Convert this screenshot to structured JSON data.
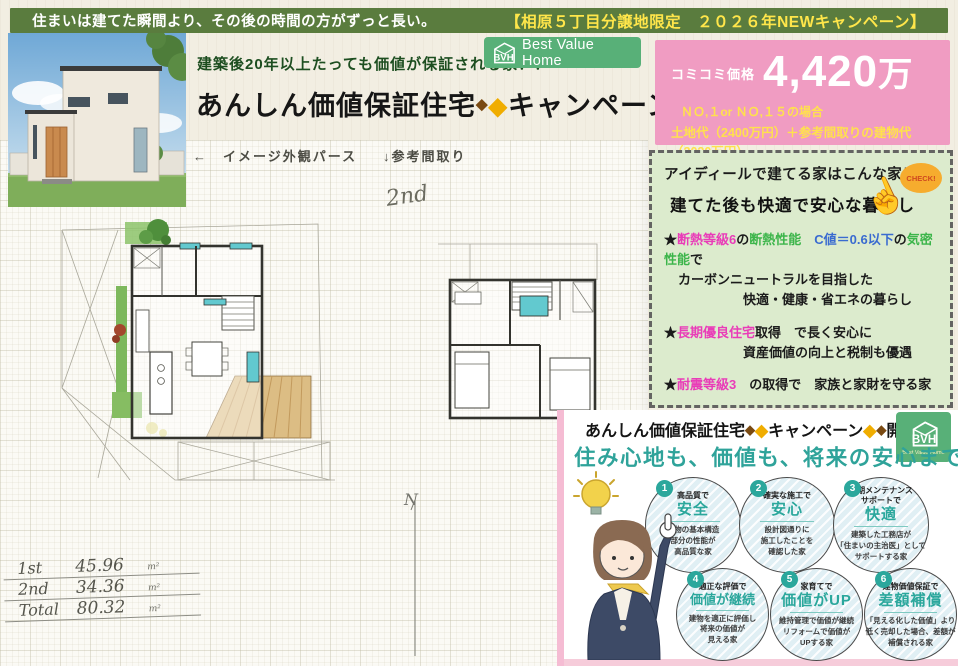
{
  "top_bar": {
    "tagline": "住まいは建てた瞬間より、その後の時間の方がずっと長い。",
    "campaign": "【相原５丁目分譲地限定　２０２６年NEWキャンペーン】"
  },
  "header": {
    "subtitle": "建築後20年以上たっても価値が保証される家！！",
    "title_name": "あんしん価値保証住宅",
    "title_campaign": "キャンペーン",
    "d1": "◆",
    "d2": "◆",
    "d3": "◆",
    "d4": "◆"
  },
  "logo": {
    "monogram": "BVH",
    "name": "Best Value Home"
  },
  "price_box": {
    "label": "コミコミ価格",
    "price_value": "4,420",
    "price_unit": "万",
    "case1": "ＮＯ,１or ＮＯ,１５の場合",
    "case2": "土地代（2400万円）＋参考間取りの建物代（2020万円）",
    "note": "＊付帯工事込、外構工事と諸経費は別途となります"
  },
  "plan_area": {
    "perspective_label": "←　イメージ外観パース",
    "floorplan_label": "↓参考間取り",
    "floor2_note": "2nd",
    "north_label": "N",
    "areas": [
      {
        "name": "1st",
        "value": "45.96",
        "unit": "m²"
      },
      {
        "name": "2nd",
        "value": "34.36",
        "unit": "m²"
      },
      {
        "name": "Total",
        "value": "80.32",
        "unit": "m²"
      }
    ]
  },
  "features": {
    "title1": "アイディールで建てる家はこんな家！",
    "title2": "建てた後も快適で安心な暮らし",
    "check": "CHECK!",
    "hand": "☝",
    "b1": {
      "star": "★",
      "t1": "断熱等級6",
      "t2": "の",
      "t3": "断熱性能",
      "t4": "　C値＝0.6以下",
      "t5": "の",
      "t6": "気密性能",
      "t7": "で",
      "line2": "カーボンニュートラルを目指した",
      "line3": "快適・健康・省エネの暮らし"
    },
    "b2": {
      "star": "★",
      "t1": "長期優良住宅",
      "t2": "取得　で長く安心に",
      "line2": "資産価値の向上と税制も優遇"
    },
    "b3": {
      "star": "★",
      "t1": "耐震等級3",
      "t2": "　の取得で　家族と家財を守る家"
    }
  },
  "banner": {
    "name": "あんしん価値保証住宅",
    "campaign": "キャンペーン",
    "suffix": "開催中",
    "d1": "◆",
    "d2": "◆",
    "d3": "◆",
    "d4": "◆"
  },
  "value_panel": {
    "headline": "住み心地も、価値も、将来の安心までも。",
    "items": [
      {
        "num": "1",
        "top": "高品質で",
        "main": "安全",
        "desc": "建物の基本構造\n部分の性能が\n高品質な家"
      },
      {
        "num": "2",
        "top": "確実な施工で",
        "main": "安心",
        "desc": "設計図通りに\n施工したことを\n確認した家"
      },
      {
        "num": "3",
        "top": "長期メンテナンス\nサポートで",
        "main": "快適",
        "desc": "建築した工務店が\n「住まいの主治医」として\nサポートする家"
      },
      {
        "num": "4",
        "top": "適正な評価で",
        "main": "価値が継続",
        "desc": "建物を適正に評価し\n将来の価値が\n見える家"
      },
      {
        "num": "5",
        "top": "家育てで",
        "main": "価値がUP",
        "desc": "維持管理で価値が継続\nリフォームで価値が\nUPする家"
      },
      {
        "num": "6",
        "top": "建物価値保証で",
        "main": "差額補償",
        "desc": "「見える化した価値」より\n低く売却した場合、差額が\n補償される家"
      }
    ]
  }
}
